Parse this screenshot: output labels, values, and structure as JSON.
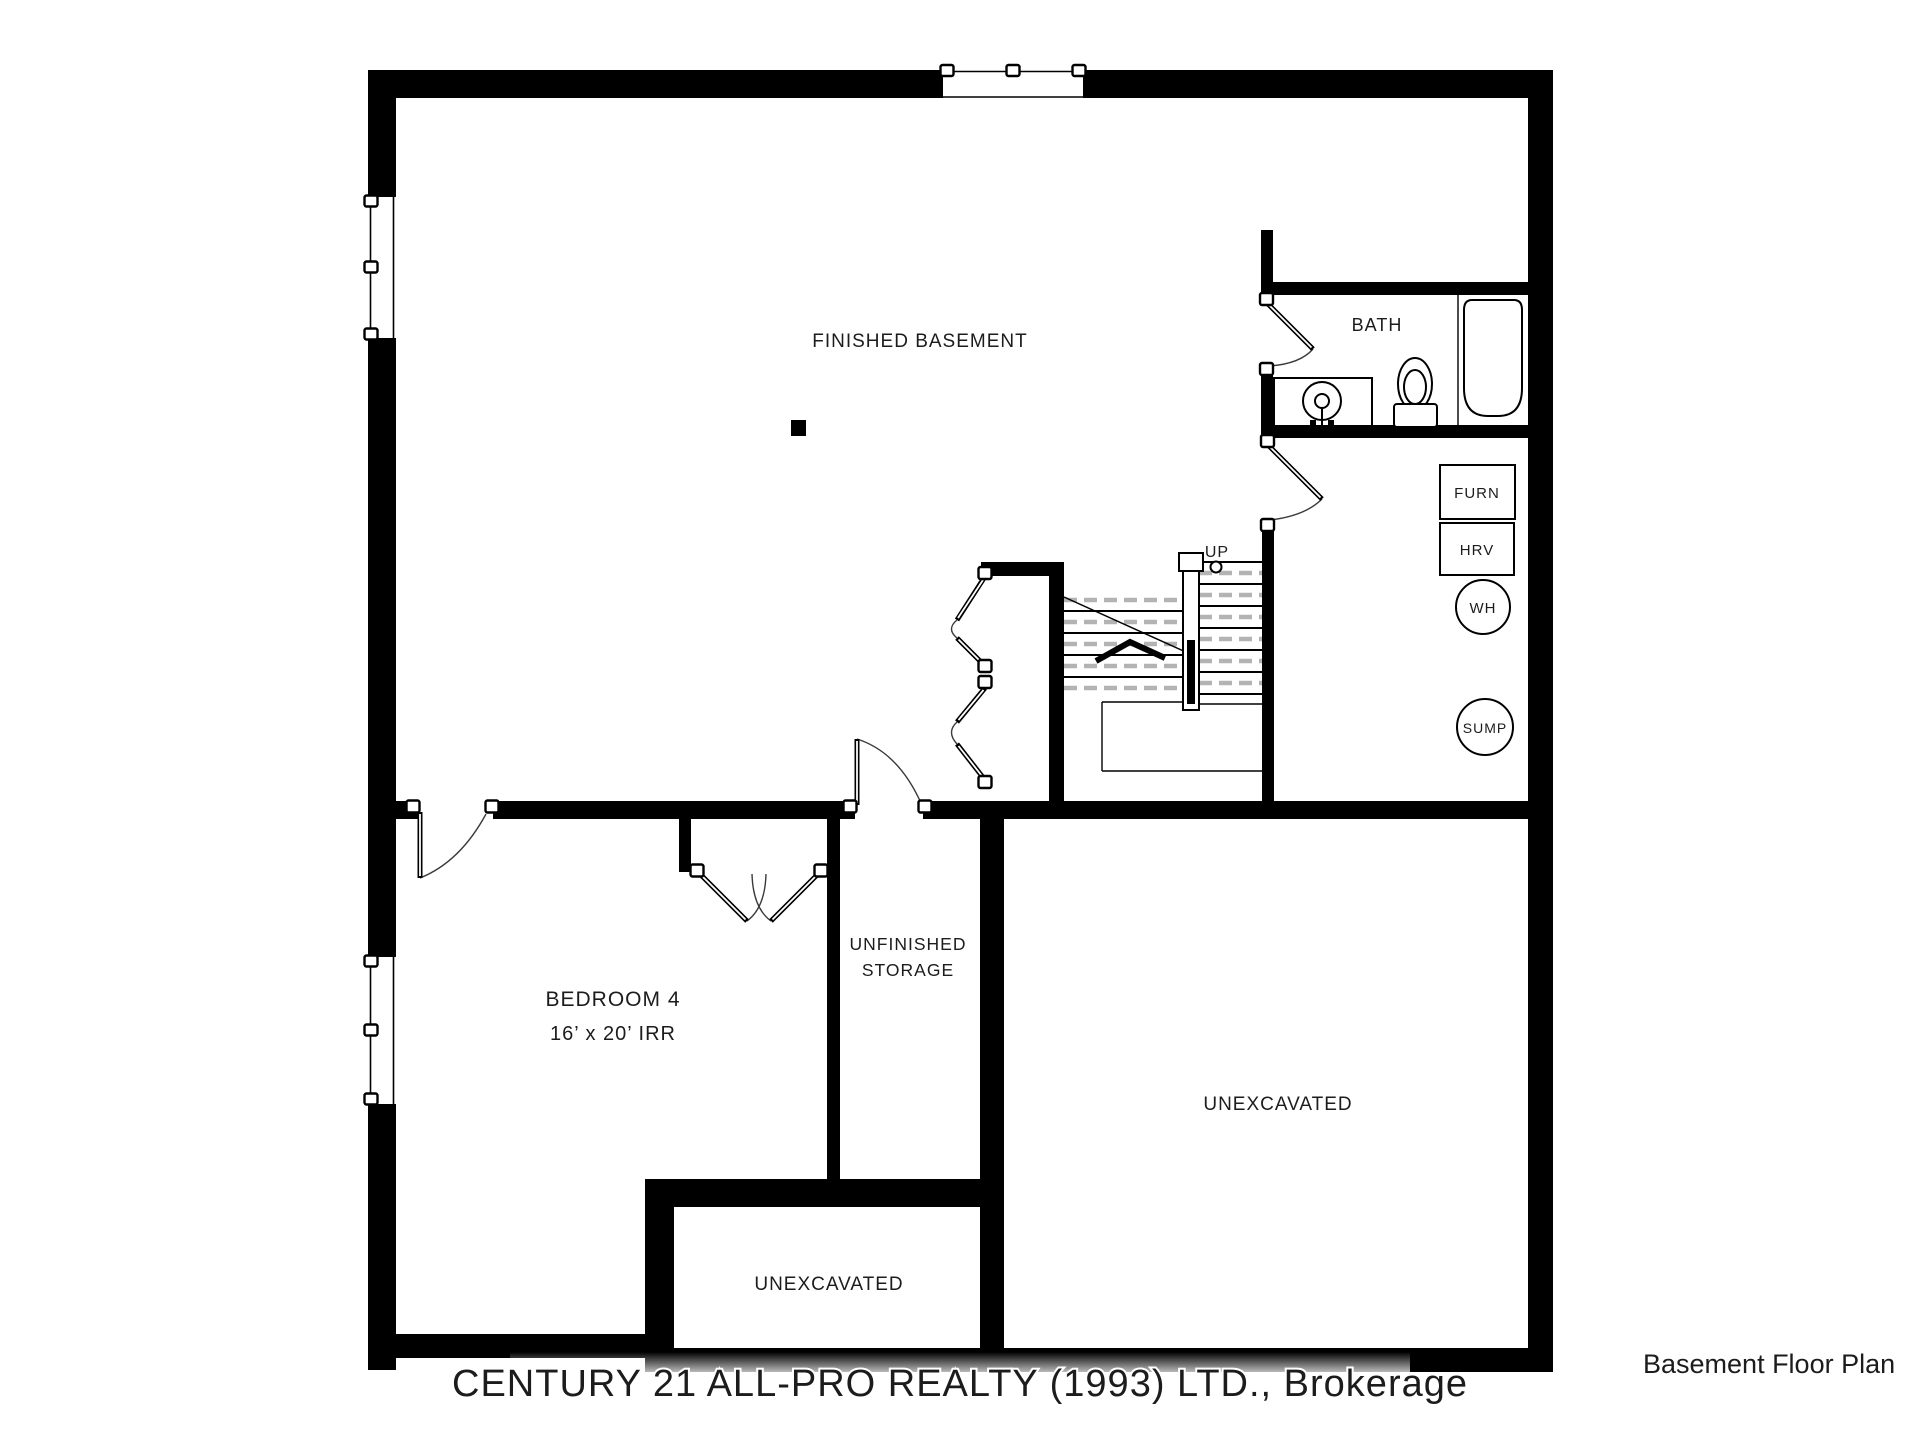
{
  "plan": {
    "title": "Basement Floor Plan",
    "watermark": "CENTURY 21 ALL-PRO REALTY (1993) LTD., Brokerage",
    "rooms": {
      "finished_basement": {
        "label": "FINISHED BASEMENT"
      },
      "bath": {
        "label": "BATH"
      },
      "bedroom4": {
        "label": "BEDROOM 4",
        "dims": "16’ x 20’ IRR"
      },
      "unfinished_storage": {
        "line1": "UNFINISHED",
        "line2": "STORAGE"
      },
      "unexcavated_small": {
        "label": "UNEXCAVATED"
      },
      "unexcavated_large": {
        "label": "UNEXCAVATED"
      }
    },
    "stairs": {
      "up_label": "UP"
    },
    "equipment": {
      "furn": "FURN",
      "hrv": "HRV",
      "wh": "WH",
      "sump": "SUMP"
    },
    "colors": {
      "wall": "#000000",
      "hidden_line": "#b3b3b3",
      "watermark": "#9e9e9e",
      "title": "#2e3b56",
      "label": "#1c1c1c"
    }
  }
}
